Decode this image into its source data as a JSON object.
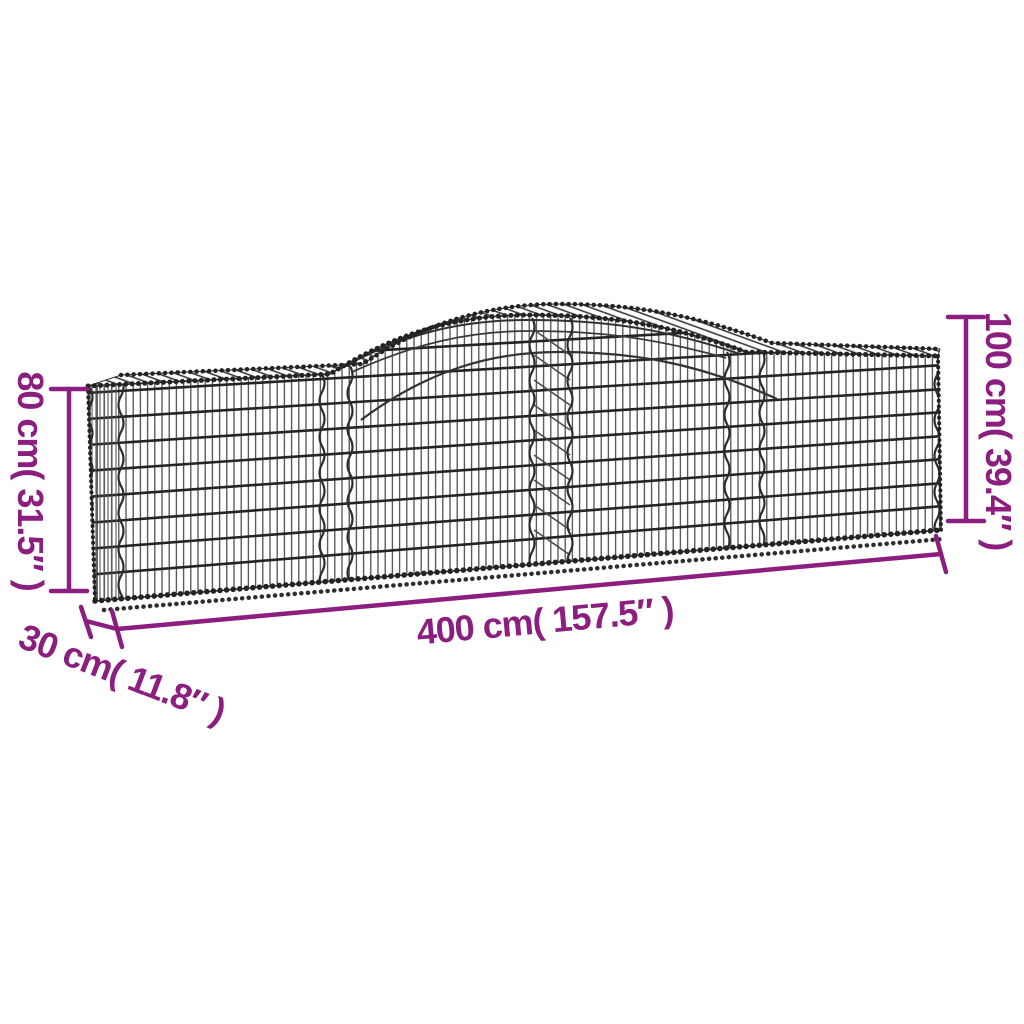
{
  "figure": {
    "description": "Arched gabion basket wire-mesh product dimension diagram",
    "colors": {
      "annotation": "#8B1E7F",
      "wire": "#2B2B2B",
      "background": "#FFFFFF"
    },
    "dimensions": {
      "height_left": {
        "label": "80 cm( 31.5″ )",
        "cm": "80",
        "inches": "31.5"
      },
      "height_right": {
        "label": "100 cm( 39.4″ )",
        "cm": "100",
        "inches": "39.4"
      },
      "length": {
        "label": "400 cm( 157.5″ )",
        "cm": "400",
        "inches": "157.5"
      },
      "depth": {
        "label": "30 cm( 11.8″ )",
        "cm": "30",
        "inches": "11.8"
      }
    }
  }
}
